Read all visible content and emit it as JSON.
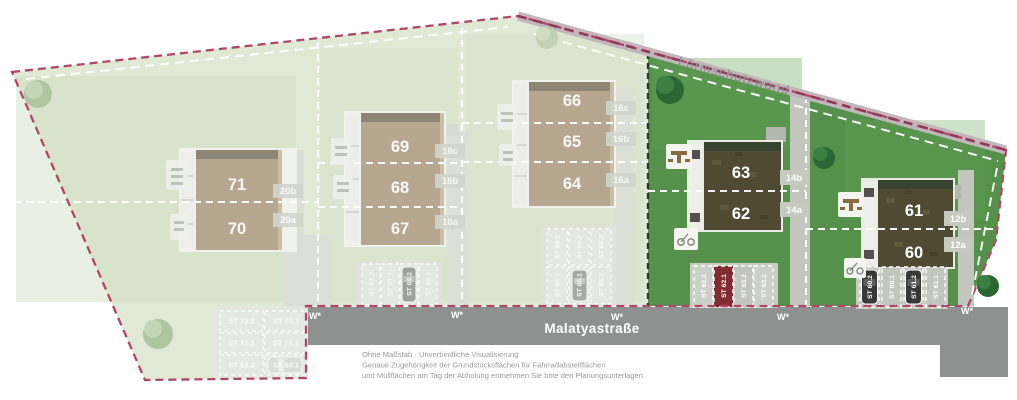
{
  "labels": {
    "noise_wall": "Lärmschutzwand",
    "street": "Malatyastraße",
    "water_marker": "W*",
    "disclaimer_line1": "Ohne Maßstab · Unverbindliche Visualisierung",
    "disclaimer_line2": "Genaue Zugehörigkeit der Grundstücksflächen für Fahrradabstellflächen",
    "disclaimer_line3": "und Müllflächen am Tag der Abholung entnehmen Sie bitte den Planungsunterlagen."
  },
  "houses": [
    {
      "number": "71",
      "address": "20b",
      "status": "faded"
    },
    {
      "number": "70",
      "address": "20a",
      "status": "faded"
    },
    {
      "number": "69",
      "address": "18c",
      "status": "faded"
    },
    {
      "number": "68",
      "address": "18b",
      "status": "faded"
    },
    {
      "number": "67",
      "address": "18a",
      "status": "faded"
    },
    {
      "number": "66",
      "address": "16c",
      "status": "faded"
    },
    {
      "number": "65",
      "address": "16b",
      "status": "faded"
    },
    {
      "number": "64",
      "address": "16a",
      "status": "faded"
    },
    {
      "number": "63",
      "address": "14b",
      "status": "available"
    },
    {
      "number": "62",
      "address": "14a",
      "status": "available"
    },
    {
      "number": "61",
      "address": "12b",
      "status": "available"
    },
    {
      "number": "60",
      "address": "12a",
      "status": "available"
    }
  ],
  "parking": {
    "left_block": [
      "ST 70.2",
      "ST 70.1",
      "ST 71.2",
      "ST 71.1",
      "ST 68.2",
      "ST 68.1"
    ],
    "row_67_69": [
      "ST 67.2",
      "ST 67.1",
      "ST 69.2",
      "ST 69.1"
    ],
    "mid_top": [
      "ST 64.2",
      "ST 66.2",
      "ST 65.2"
    ],
    "mid_bottom": [
      "ST 64.1",
      "ST 66.1",
      "ST 65.1"
    ],
    "row_62_63": [
      "ST 62.2",
      "ST 62.1",
      "ST 63.2",
      "ST 63.1"
    ],
    "row_60_61": [
      "ST 60.2",
      "ST 60.1",
      "ST 61.2",
      "ST 61.1"
    ],
    "selected": "ST 62.1"
  },
  "colors": {
    "boundary": "#ae4868",
    "grass_active": "#55914b",
    "grass_faded": "#e0e8d6",
    "street": "#8f9191",
    "selected_stall": "#802c31"
  }
}
